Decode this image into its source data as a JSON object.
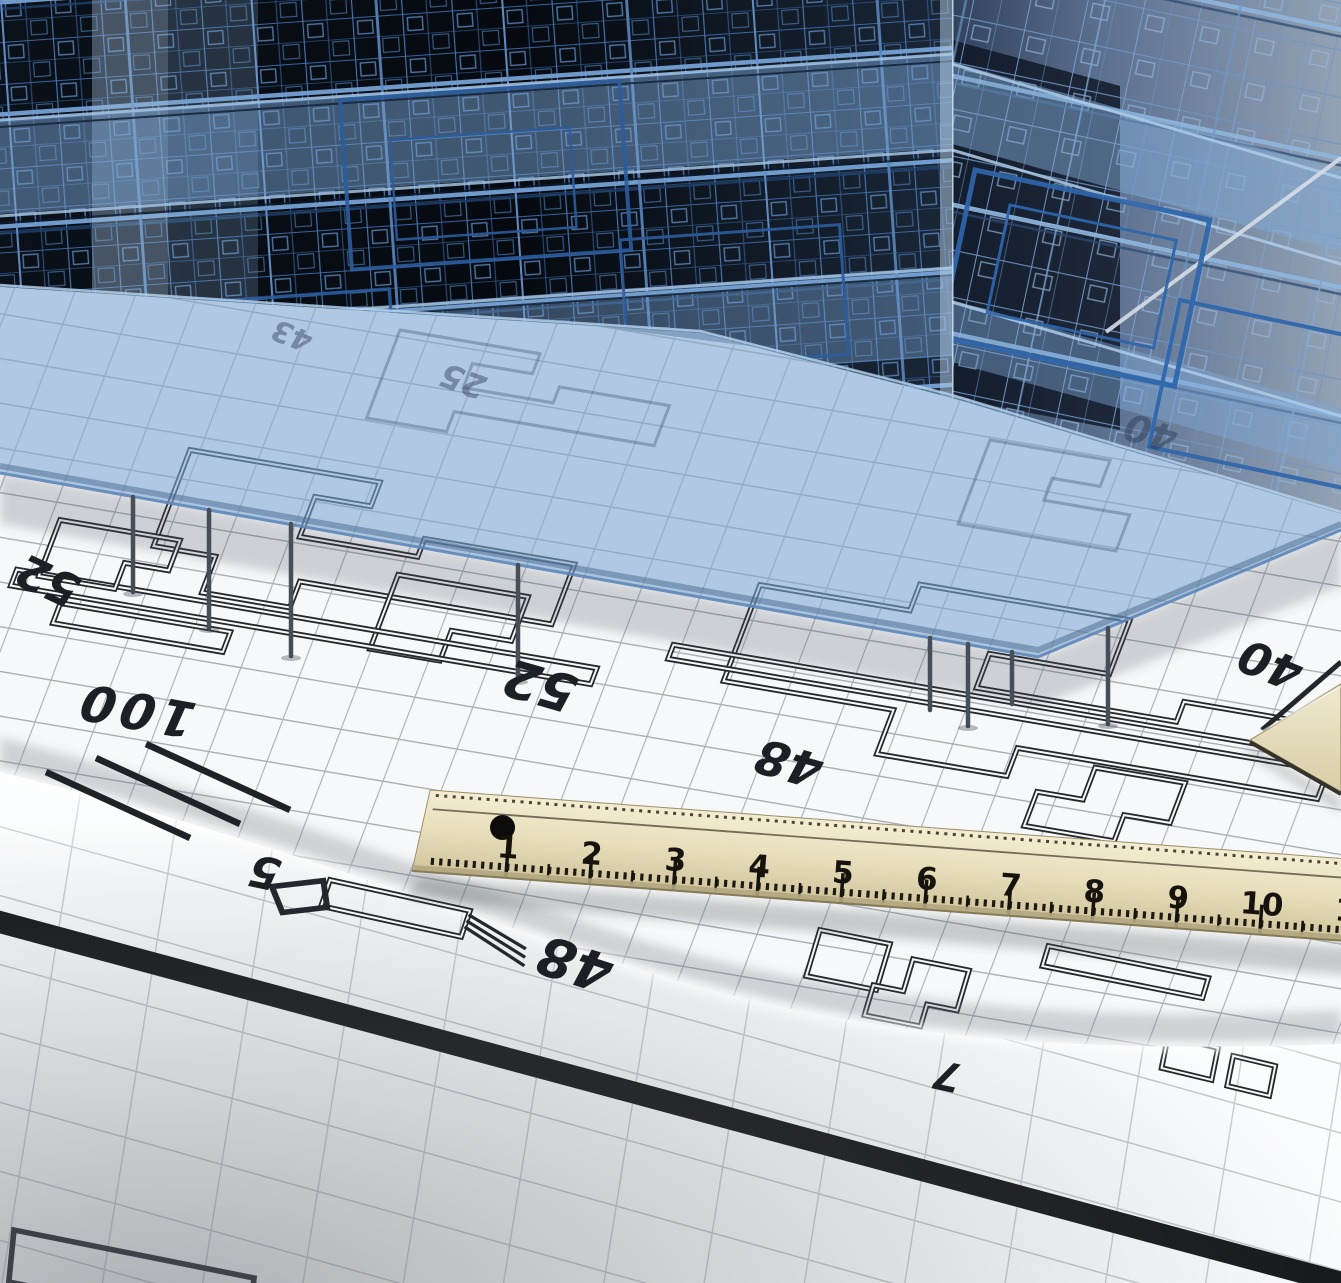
{
  "image": {
    "subject": "3D wireframe building model standing on architectural blueprints with a wooden ruler",
    "objects": [
      "wireframe-building",
      "ground-slab",
      "blueprint-sheet",
      "rolled-blueprint",
      "wooden-ruler",
      "set-square-tip"
    ]
  },
  "annotations": [
    {
      "value": "52"
    },
    {
      "value": "100"
    },
    {
      "value": "52"
    },
    {
      "value": "48"
    },
    {
      "value": "40"
    },
    {
      "value": "40"
    },
    {
      "value": "25"
    },
    {
      "value": "43"
    },
    {
      "value": "5"
    },
    {
      "value": "48"
    },
    {
      "value": "7"
    }
  ],
  "ruler": {
    "numbers": [
      "1",
      "2",
      "3",
      "4",
      "5",
      "6",
      "7",
      "8",
      "9",
      "10",
      "1"
    ]
  },
  "colors": {
    "wireframe_blue": "#2f6ab2",
    "slab_blue": "#7ca6d3",
    "backdrop_gray": "#8795a5",
    "paper_white": "#f7f8f9",
    "grid_gray": "#a6acb3",
    "plan_ink": "#24272b",
    "ruler_wood": "#e7ddba",
    "plot_line_black": "#17191b"
  }
}
